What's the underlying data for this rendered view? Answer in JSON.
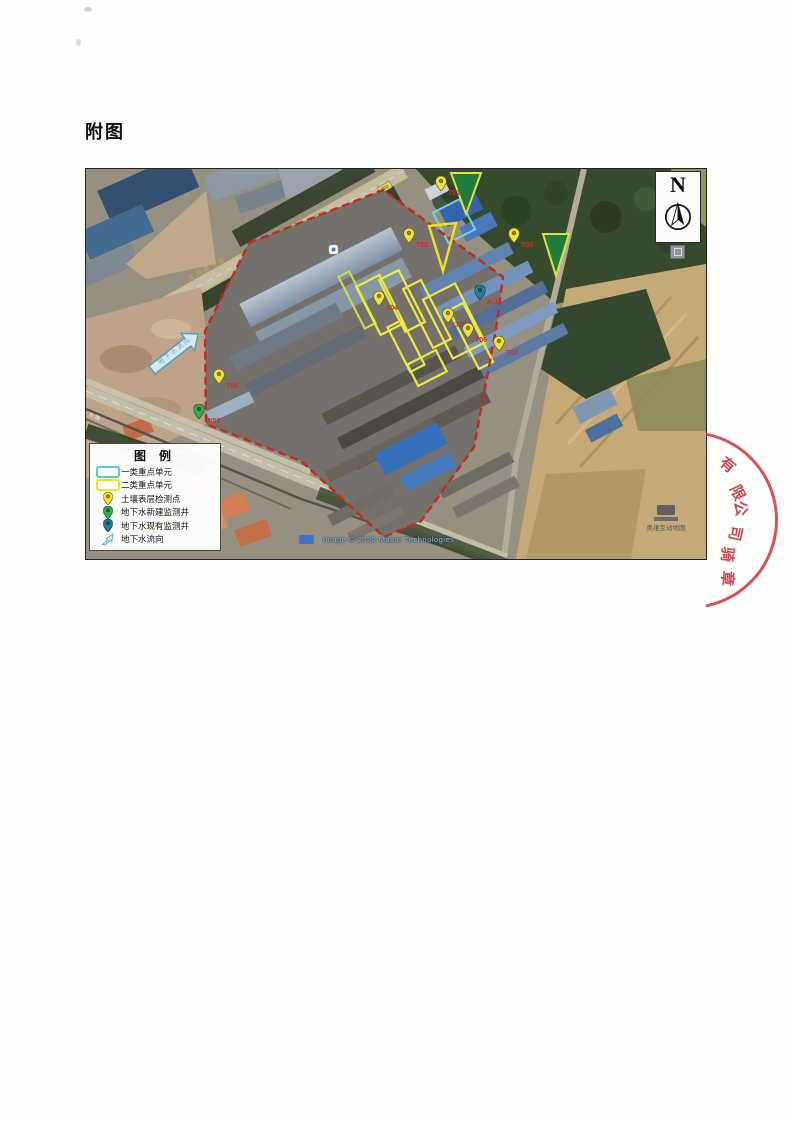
{
  "page": {
    "title": "附图"
  },
  "map": {
    "north_label": "N",
    "attribution": "Image © 2020 Maxar Technologies",
    "watermark": "奥维互动地图",
    "road_label_main": "东风南大街",
    "road_label_bottom": "东路",
    "road_badge": "302",
    "flow_arrow_label": "地下水流向",
    "legend": {
      "title": "图 例",
      "items": [
        {
          "name": "class1-unit",
          "label": "一类重点单元",
          "color": "#5bc8dc"
        },
        {
          "name": "class2-unit",
          "label": "二类重点单元",
          "color": "#ece60f"
        },
        {
          "name": "soil-point",
          "label": "土壤表层检测点",
          "color": "#f5e62c"
        },
        {
          "name": "new-well",
          "label": "地下水新建监测井",
          "color": "#2fae4e"
        },
        {
          "name": "existing-well",
          "label": "地下水现有监测井",
          "color": "#1b7f9e"
        },
        {
          "name": "flow-arrow",
          "label": "地下水流向",
          "color": "#41a6c8"
        }
      ]
    },
    "markers": [
      {
        "type": "soil",
        "x": 355,
        "y": 22,
        "label": "T01"
      },
      {
        "type": "soil",
        "x": 323,
        "y": 74,
        "label": "T02"
      },
      {
        "type": "soil",
        "x": 428,
        "y": 74,
        "label": "T03"
      },
      {
        "type": "soil",
        "x": 293,
        "y": 137,
        "label": "T04"
      },
      {
        "type": "soil",
        "x": 362,
        "y": 154,
        "label": "T05"
      },
      {
        "type": "soil",
        "x": 382,
        "y": 169,
        "label": "T06"
      },
      {
        "type": "soil",
        "x": 413,
        "y": 182,
        "label": "T07"
      },
      {
        "type": "soil",
        "x": 133,
        "y": 215,
        "label": "T08"
      },
      {
        "type": "green",
        "x": 113,
        "y": 250,
        "label": "W01"
      },
      {
        "type": "teal",
        "x": 394,
        "y": 131,
        "label": "A-1"
      }
    ]
  },
  "stamp": {
    "arc_chars": [
      "有",
      "限",
      "公",
      "司"
    ],
    "inner_chars": [
      "骑",
      "章"
    ]
  }
}
